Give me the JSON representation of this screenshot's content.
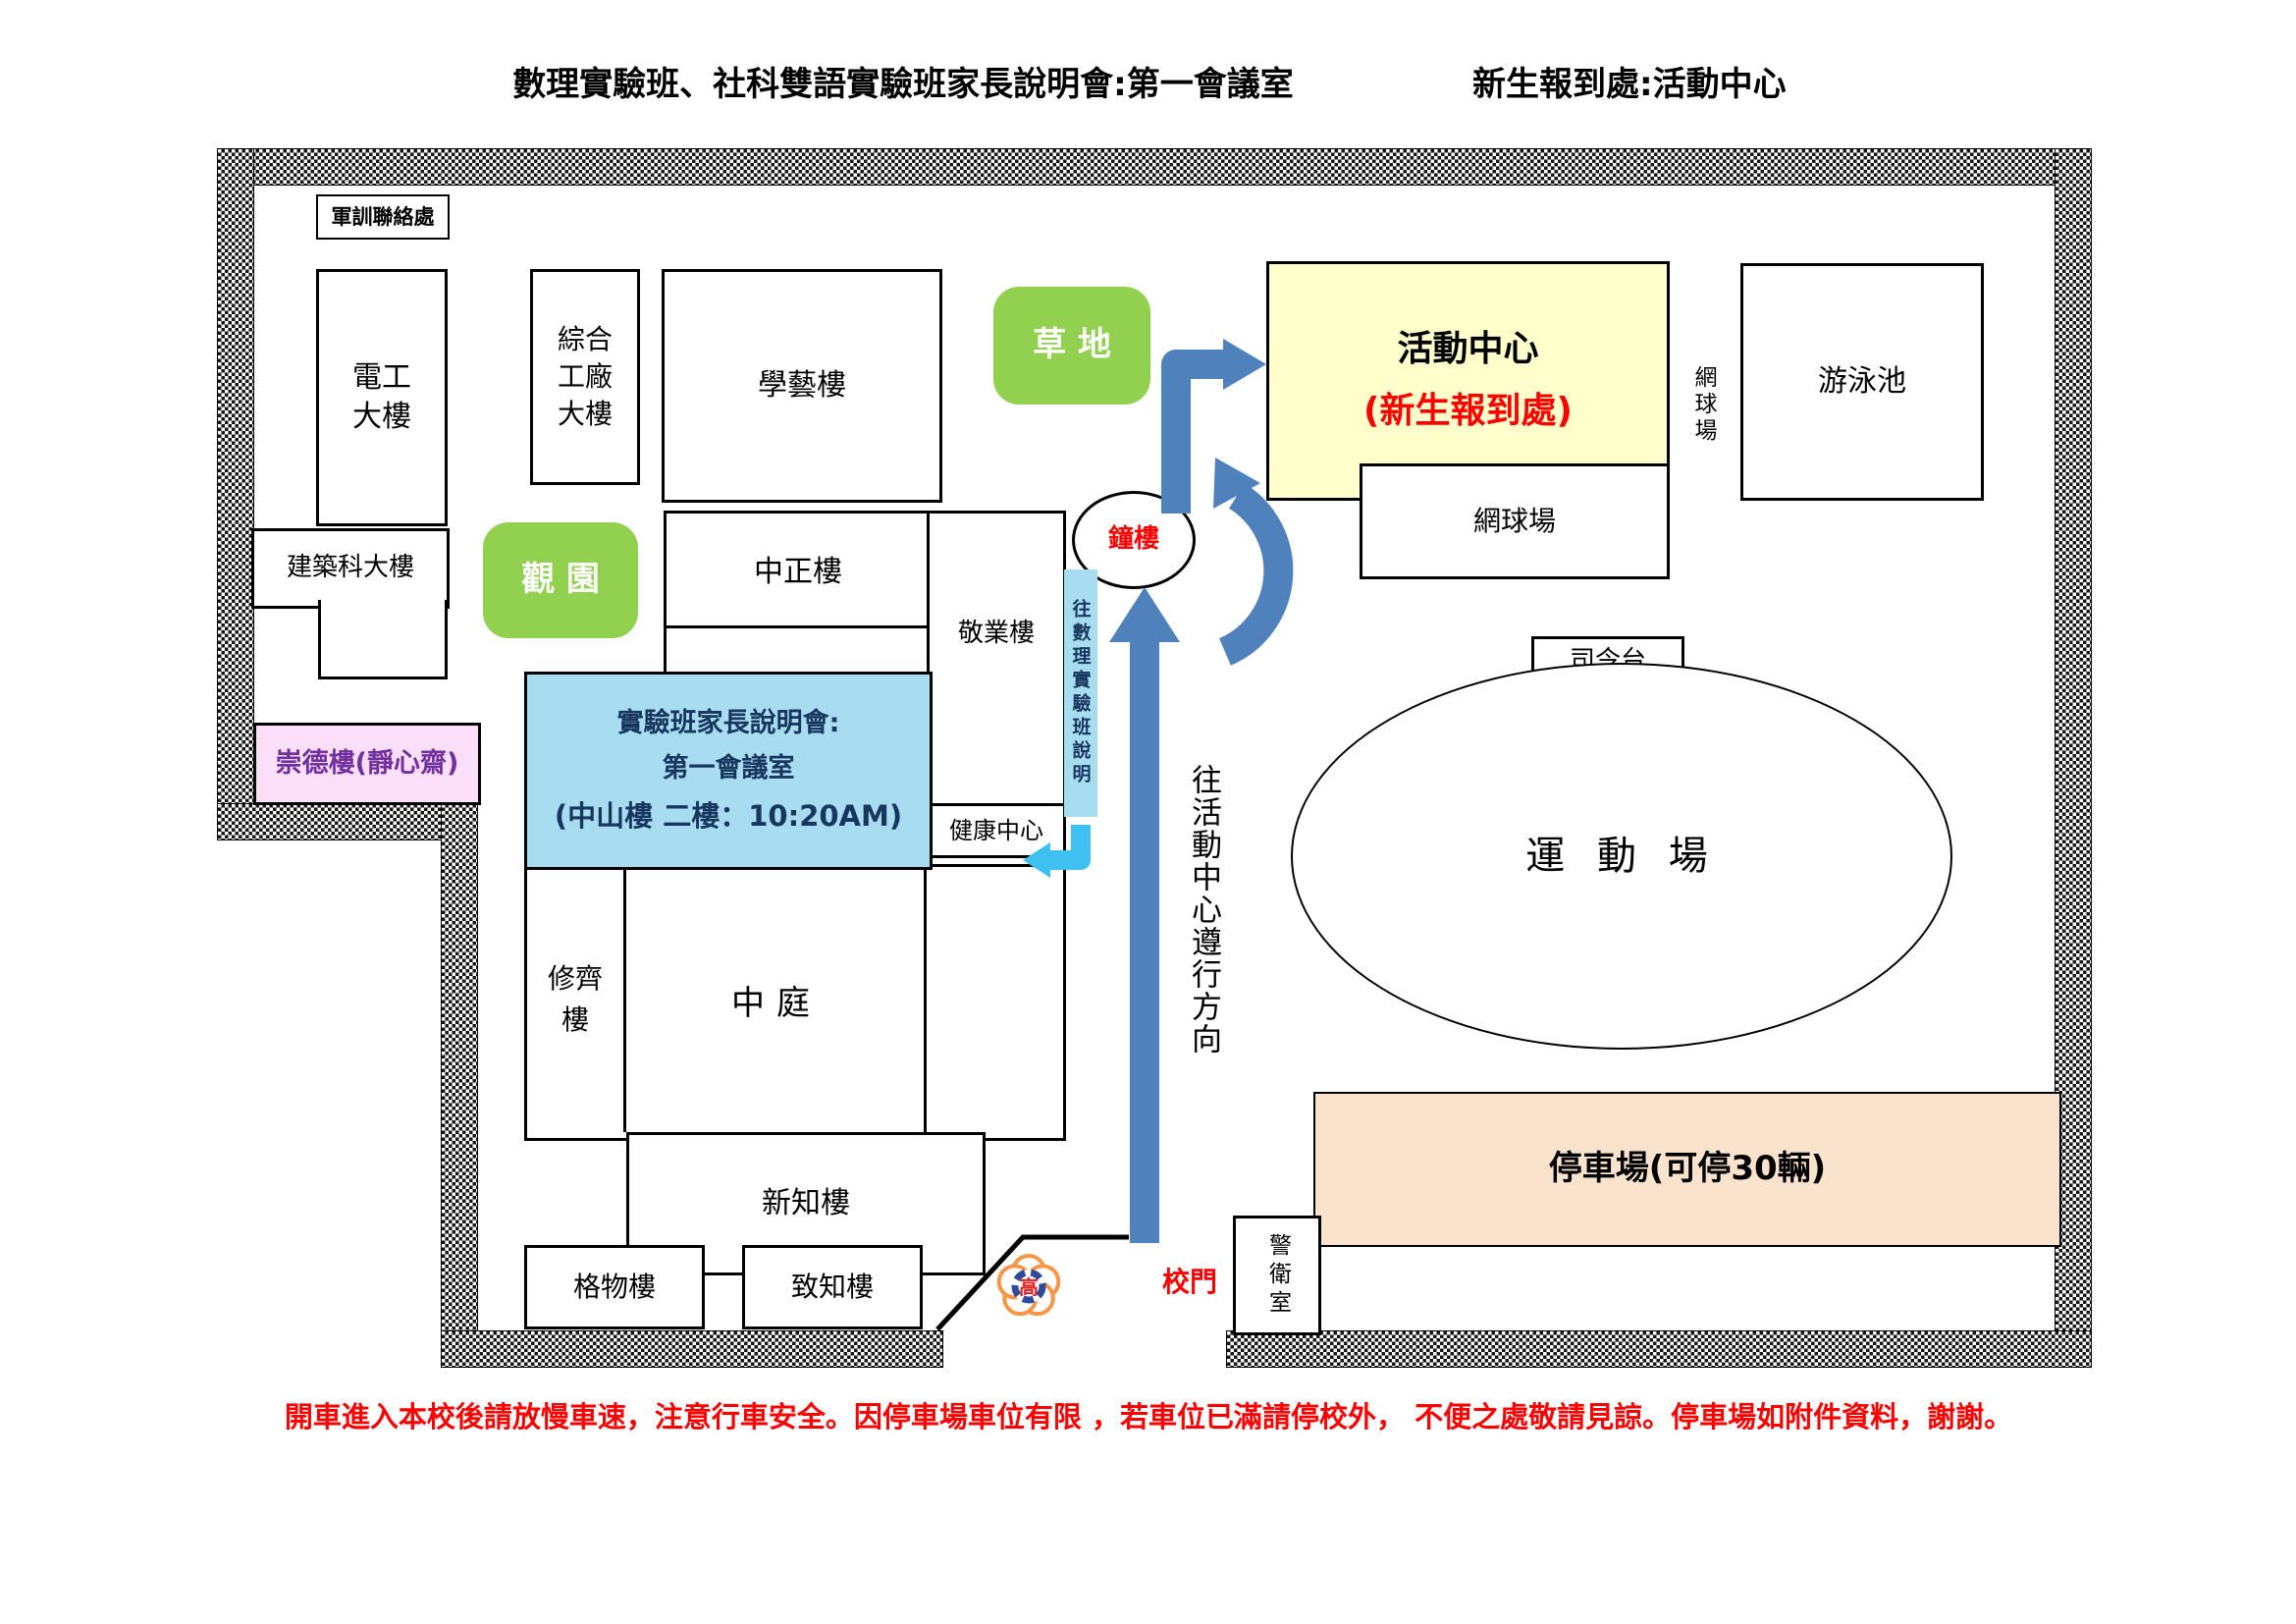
{
  "titles": {
    "left": "數理實驗班、社科雙語實驗班家長說明會:第一會議室",
    "right": "新生報到處:活動中心"
  },
  "buildings": {
    "junxun": "軍訓聯絡處",
    "diangong": "電工\n大樓",
    "zonghe": "綜合\n工廠\n大樓",
    "xueyi": "學藝樓",
    "jianzhu": "建築科大樓",
    "chongde": "崇德樓(靜心齋)",
    "guanyuan": "觀 園",
    "caodi": "草 地",
    "zhongzheng": "中正樓",
    "jingye": "敬業樓",
    "jiankang": "健康中心",
    "shuoming1": "實驗班家長說明會:",
    "shuoming2": "第一會議室",
    "shuoming3": "(中山樓 二樓：10:20AM)",
    "xiuqi": "修齊\n樓",
    "zhongting": "中庭",
    "xinzhi": "新知樓",
    "gewu": "格物樓",
    "zhizhi": "致知樓",
    "huodong_main": "活動中心",
    "huodong_sub": "(新生報到處)",
    "tennis_vertical": "網球場",
    "youyong": "游泳池",
    "tennis_box": "網球場",
    "siling": "司令台",
    "yundong": "運 動 場",
    "tingche": "停車場(可停30輛)",
    "jingwei": "警衛室",
    "zhonglou": "鐘樓"
  },
  "labels": {
    "gate": "校門",
    "direction": "往活動中心遵行方向",
    "strip": "往數理實驗班說明",
    "logo_char": "高"
  },
  "note": "開車進入本校後請放慢車速，注意行車安全。因停車場車位有限 ，若車位已滿請停校外， 不便之處敬請見諒。停車場如附件資料，謝謝。",
  "colors": {
    "arrow_blue": "#4F81BD",
    "arrow_cyan": "#3EC1F0",
    "grass_green": "#92D050",
    "center_yellow": "#FFFFCC",
    "info_blue": "#A8DCF0",
    "chongde_pink": "#FBDEF8",
    "parking_peach": "#FAE3CD",
    "alert_red": "#FF0000",
    "navy_text": "#17375E",
    "purple_text": "#7030A0",
    "logo_orange": "#F79646",
    "logo_blue": "#2E4B9B"
  }
}
